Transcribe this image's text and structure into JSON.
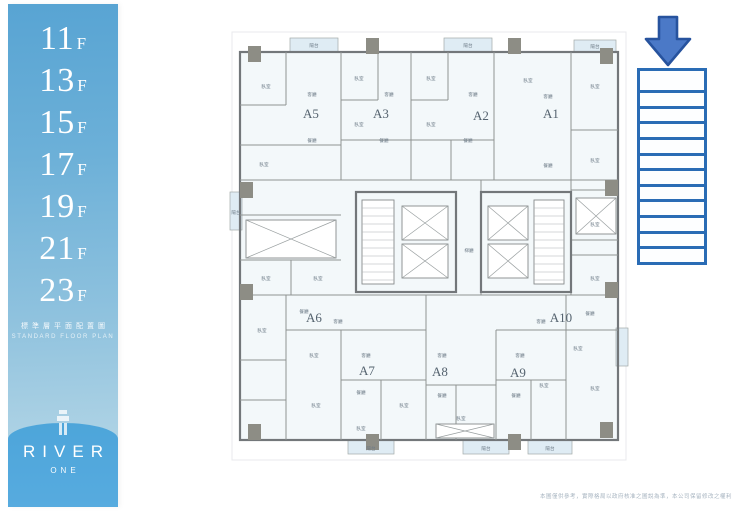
{
  "sidebar": {
    "floors": [
      {
        "number": "11",
        "suffix": "F"
      },
      {
        "number": "13",
        "suffix": "F"
      },
      {
        "number": "15",
        "suffix": "F"
      },
      {
        "number": "17",
        "suffix": "F"
      },
      {
        "number": "19",
        "suffix": "F"
      },
      {
        "number": "21",
        "suffix": "F"
      },
      {
        "number": "23",
        "suffix": "F"
      }
    ],
    "subtitle_zh": "標準層平面配置圖",
    "subtitle_en": "STANDARD FLOOR PLAN",
    "brand": "RIVER",
    "brand_sub": "ONE"
  },
  "plan": {
    "units": [
      {
        "id": "A5",
        "x": 85,
        "y": 88
      },
      {
        "id": "A3",
        "x": 155,
        "y": 88
      },
      {
        "id": "A2",
        "x": 255,
        "y": 90
      },
      {
        "id": "A1",
        "x": 325,
        "y": 88
      },
      {
        "id": "A6",
        "x": 88,
        "y": 292
      },
      {
        "id": "A10",
        "x": 335,
        "y": 292
      },
      {
        "id": "A7",
        "x": 141,
        "y": 345
      },
      {
        "id": "A8",
        "x": 214,
        "y": 346
      },
      {
        "id": "A9",
        "x": 292,
        "y": 347
      }
    ],
    "rooms": [
      {
        "label": "臥室",
        "x": 40,
        "y": 58
      },
      {
        "label": "客廳",
        "x": 86,
        "y": 66
      },
      {
        "label": "餐廳",
        "x": 86,
        "y": 112
      },
      {
        "label": "臥室",
        "x": 38,
        "y": 136
      },
      {
        "label": "臥室",
        "x": 133,
        "y": 50
      },
      {
        "label": "客廳",
        "x": 163,
        "y": 66
      },
      {
        "label": "臥室",
        "x": 133,
        "y": 96
      },
      {
        "label": "餐廳",
        "x": 158,
        "y": 112
      },
      {
        "label": "臥室",
        "x": 205,
        "y": 50
      },
      {
        "label": "客廳",
        "x": 247,
        "y": 66
      },
      {
        "label": "臥室",
        "x": 205,
        "y": 96
      },
      {
        "label": "餐廳",
        "x": 242,
        "y": 112
      },
      {
        "label": "臥室",
        "x": 302,
        "y": 52
      },
      {
        "label": "客廳",
        "x": 322,
        "y": 68
      },
      {
        "label": "臥室",
        "x": 369,
        "y": 58
      },
      {
        "label": "餐廳",
        "x": 322,
        "y": 137
      },
      {
        "label": "臥室",
        "x": 369,
        "y": 132
      },
      {
        "label": "臥室",
        "x": 369,
        "y": 196
      },
      {
        "label": "臥室",
        "x": 369,
        "y": 250
      },
      {
        "label": "陽台",
        "x": 88,
        "y": 17
      },
      {
        "label": "陽台",
        "x": 242,
        "y": 17
      },
      {
        "label": "陽台",
        "x": 369,
        "y": 18
      },
      {
        "label": "陽台",
        "x": 10,
        "y": 184
      },
      {
        "label": "臥室",
        "x": 40,
        "y": 250
      },
      {
        "label": "臥室",
        "x": 92,
        "y": 250
      },
      {
        "label": "梯廳",
        "x": 243,
        "y": 222
      },
      {
        "label": "餐廳",
        "x": 78,
        "y": 283
      },
      {
        "label": "客廳",
        "x": 112,
        "y": 293
      },
      {
        "label": "臥室",
        "x": 36,
        "y": 302
      },
      {
        "label": "臥室",
        "x": 88,
        "y": 327
      },
      {
        "label": "客廳",
        "x": 140,
        "y": 327
      },
      {
        "label": "餐廳",
        "x": 135,
        "y": 364
      },
      {
        "label": "臥室",
        "x": 90,
        "y": 377
      },
      {
        "label": "臥室",
        "x": 135,
        "y": 400
      },
      {
        "label": "臥室",
        "x": 178,
        "y": 377
      },
      {
        "label": "客廳",
        "x": 216,
        "y": 327
      },
      {
        "label": "餐廳",
        "x": 216,
        "y": 367
      },
      {
        "label": "臥室",
        "x": 235,
        "y": 390
      },
      {
        "label": "客廳",
        "x": 294,
        "y": 327
      },
      {
        "label": "餐廳",
        "x": 290,
        "y": 367
      },
      {
        "label": "臥室",
        "x": 318,
        "y": 357
      },
      {
        "label": "客廳",
        "x": 315,
        "y": 293
      },
      {
        "label": "餐廳",
        "x": 364,
        "y": 285
      },
      {
        "label": "臥室",
        "x": 352,
        "y": 320
      },
      {
        "label": "臥室",
        "x": 369,
        "y": 360
      },
      {
        "label": "陽台",
        "x": 145,
        "y": 420
      },
      {
        "label": "陽台",
        "x": 260,
        "y": 420
      },
      {
        "label": "陽台",
        "x": 324,
        "y": 420
      }
    ]
  },
  "legend_table": {
    "rows": 12
  },
  "footer": {
    "disclaimer": "本圖僅供參考，實際格局以政府核准之圖說為準，本公司保留修改之權利"
  },
  "colors": {
    "arrow_fill": "#4b79c7",
    "arrow_stroke": "#27539e",
    "table_border": "#2a6cb5",
    "sidebar_top": "#58a4d3",
    "sidebar_bottom": "#4da5da"
  }
}
